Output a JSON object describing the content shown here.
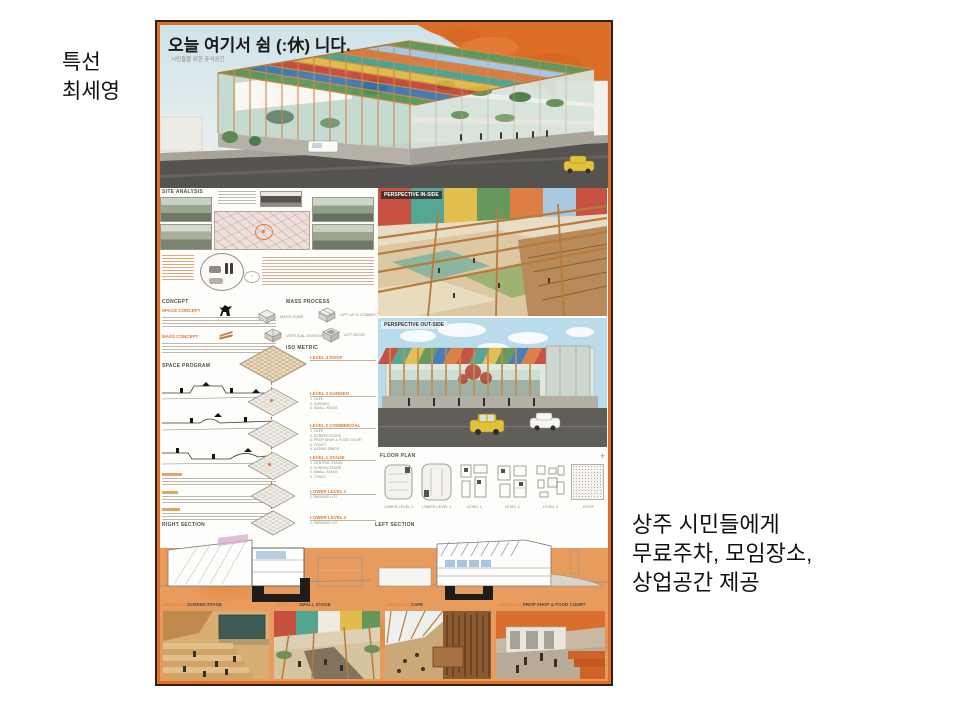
{
  "slide": {
    "award": "특선",
    "author": "최세영",
    "caption": [
      "상주 시민들에게",
      "무료주차, 모임장소,",
      "상업공간 제공"
    ]
  },
  "poster": {
    "title": "오늘 여기서 쉼 (:休) 니다.",
    "subtitle": "시민들을 위한 휴식공간",
    "headings": {
      "site_analysis": "SITE ANALYSIS",
      "concept": "CONCEPT",
      "space_concept": "SPACE CONCEPT",
      "mass_concept": "MASS CONCEPT",
      "mass_process": "MASS PROCESS",
      "iso_metric": "ISO METRIC",
      "space_program": "SPACE PROGRAM",
      "floor_plan": "FLOOR PLAN",
      "right_section": "RIGHT SECTION",
      "left_section": "LEFT SECTION"
    },
    "perspectives": {
      "inside": "PERSPECTIVE IN-SIDE",
      "outside": "PERSPECTIVE OUT-SIDE"
    },
    "mass_steps": [
      "MASS CUBE",
      "VERTICAL DIVISION",
      "LIFT UP & CONNECT",
      "LIFT MOVE"
    ],
    "iso_levels": [
      {
        "label": "LEVEL 4  ROOF",
        "items": ""
      },
      {
        "label": "LEVEL 3  GARDEN",
        "items": "1. CAFE\n2. GARDEN\n3. SMALL STAGE"
      },
      {
        "label": "LEVEL 2  COMMERCIAL",
        "items": "1. CAFE\n2. SCREEN STAGE\n3. PROP SHOP & FOOD COURT\n4. TOILET\n5. EATING SPACE"
      },
      {
        "label": "LEVEL 1  STAGE",
        "items": "1. CENTRAL STAGE\n2. SCREEN STAGE\n3. SMALL STAGE\n4. TOILET"
      },
      {
        "label": "LOWER LEVEL 1",
        "items": "1. PARKING LOT"
      },
      {
        "label": "LOWER LEVEL 2",
        "items": "1. PARKING LOT"
      }
    ],
    "floor_plans": [
      "LOWER LEVEL 2",
      "LOWER LEVEL 1",
      "LEVEL 1",
      "LEVEL 2",
      "LEVEL 3",
      "ROOF"
    ],
    "plus_mark": "+",
    "bottom_items": [
      {
        "level": "LEVEL 1-1",
        "name": "SCREEN STAGE"
      },
      {
        "level": "LEVEL 1-2",
        "name": "SMALL STAGE"
      },
      {
        "level": "LEVEL 2-1",
        "name": "CAFE"
      },
      {
        "level": "LEVEL 2-2",
        "name": "PROP SHOP & FOOD COURT"
      }
    ],
    "colors": {
      "frame": "#DD6E28",
      "accent": "#E07A33"
    }
  }
}
